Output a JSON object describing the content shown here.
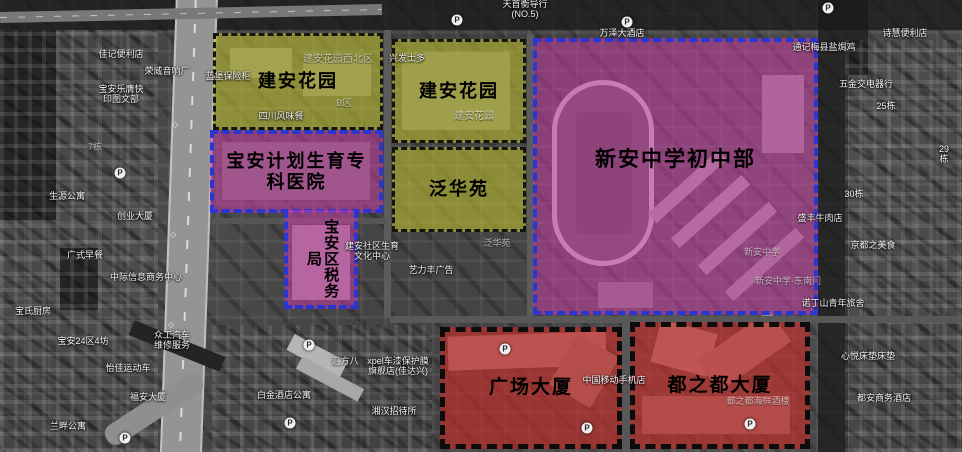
{
  "map_type": "satellite-annotated-parcels",
  "colors": {
    "residential_fill": "rgba(200,200,50,0.55)",
    "public_fill": "rgba(210,60,170,0.50)",
    "commercial_fill": "rgba(205,45,40,0.62)",
    "blue_border": "#2b36d0",
    "black_border": "#111111"
  },
  "regions": [
    {
      "label": "建安花园"
    },
    {
      "label": "建安花园"
    },
    {
      "label": "泛华苑"
    },
    {
      "label": "宝安计划生育专\n科医院"
    },
    {
      "label": "宝安区税务局"
    },
    {
      "label": "新安中学初中部"
    },
    {
      "label": "广场大厦"
    },
    {
      "label": "都之都大厦"
    }
  ],
  "icons": {
    "parking_glyph": "P"
  },
  "bg_labels": [
    {
      "text": "天首衡导行\n(NO.5)"
    },
    {
      "text": "万泽大酒店"
    },
    {
      "text": "兴发士多"
    },
    {
      "text": "荣威音响厂"
    },
    {
      "text": "佳记便利店"
    },
    {
      "text": "宝安乐膺快\n印图文部"
    },
    {
      "text": "蓝堡保险柜"
    },
    {
      "text": "建安花园西北区"
    },
    {
      "text": "B区"
    },
    {
      "text": "四川风味餐"
    },
    {
      "text": "建安花园"
    },
    {
      "text": "生源公寓"
    },
    {
      "text": "创业大厦"
    },
    {
      "text": "广式早餐"
    },
    {
      "text": "中际信息商务中心"
    },
    {
      "text": "宝氏厨房"
    },
    {
      "text": "宝安24区4坊"
    },
    {
      "text": "众工汽车\n维修服务"
    },
    {
      "text": "怡佳运动车"
    },
    {
      "text": "福安大厦"
    },
    {
      "text": "兰畔公寓"
    },
    {
      "text": "白金酒店公寓"
    },
    {
      "text": "汇方八"
    },
    {
      "text": "xpel车漆保护膜\n旗舰店(佳达兴)"
    },
    {
      "text": "湘汉招待所"
    },
    {
      "text": "建安社区生育\n文化中心"
    },
    {
      "text": "艺力丰广告"
    },
    {
      "text": "泛华苑"
    },
    {
      "text": "中国移动手机店"
    },
    {
      "text": "新安中学"
    },
    {
      "text": "新安中学·东南门"
    },
    {
      "text": "都之都海鲜酒楼"
    },
    {
      "text": "诗慧便利店"
    },
    {
      "text": "通记梅县盐焗鸡"
    },
    {
      "text": "五金交电器行"
    },
    {
      "text": "25栋"
    },
    {
      "text": "29栋"
    },
    {
      "text": "30栋"
    },
    {
      "text": "京都之美食"
    },
    {
      "text": "盛丰牛肉店"
    },
    {
      "text": "诺丁山青年旅舍"
    },
    {
      "text": "心悦床垫床垫"
    },
    {
      "text": "都安商务酒店"
    },
    {
      "text": "7栋"
    }
  ]
}
